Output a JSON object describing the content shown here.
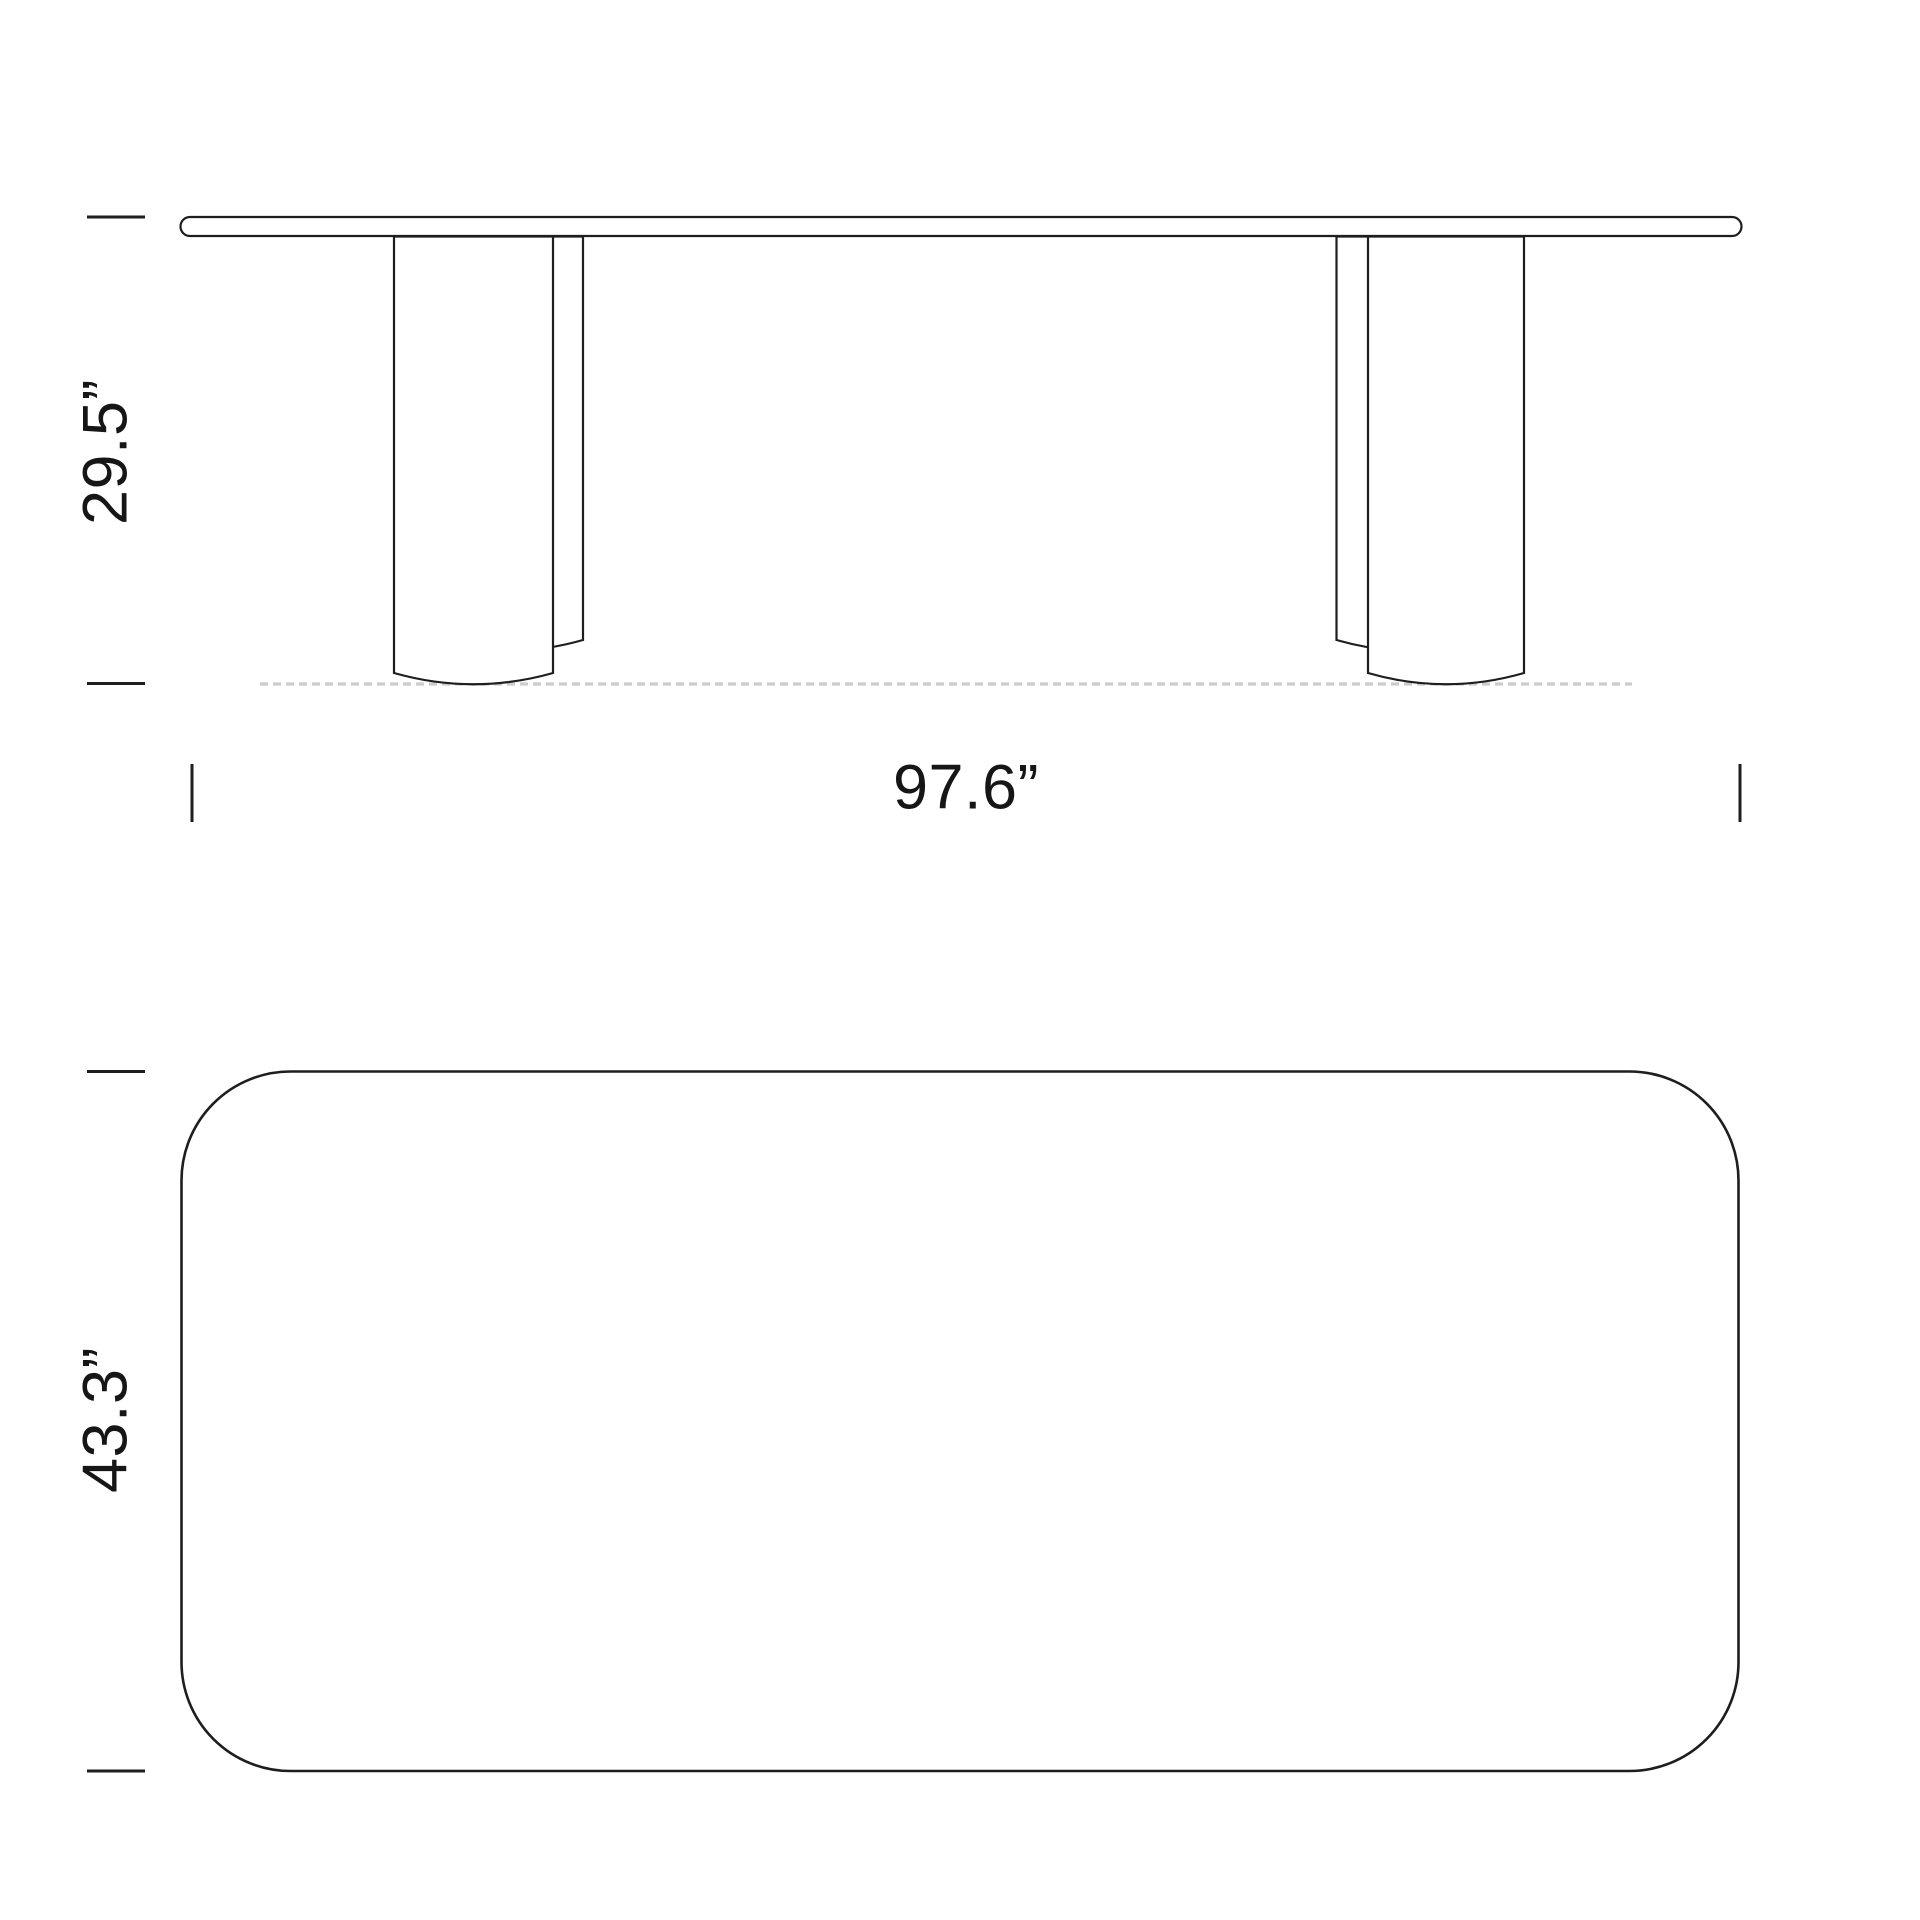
{
  "style": {
    "background": "#ffffff",
    "line_color": "#1e1e1e",
    "floor_line_color": "#cccccc",
    "text_color": "#161616"
  },
  "front_view": {
    "height_label": "29.5”",
    "width_label": "97.6”"
  },
  "top_view": {
    "depth_label": "43.3”"
  }
}
